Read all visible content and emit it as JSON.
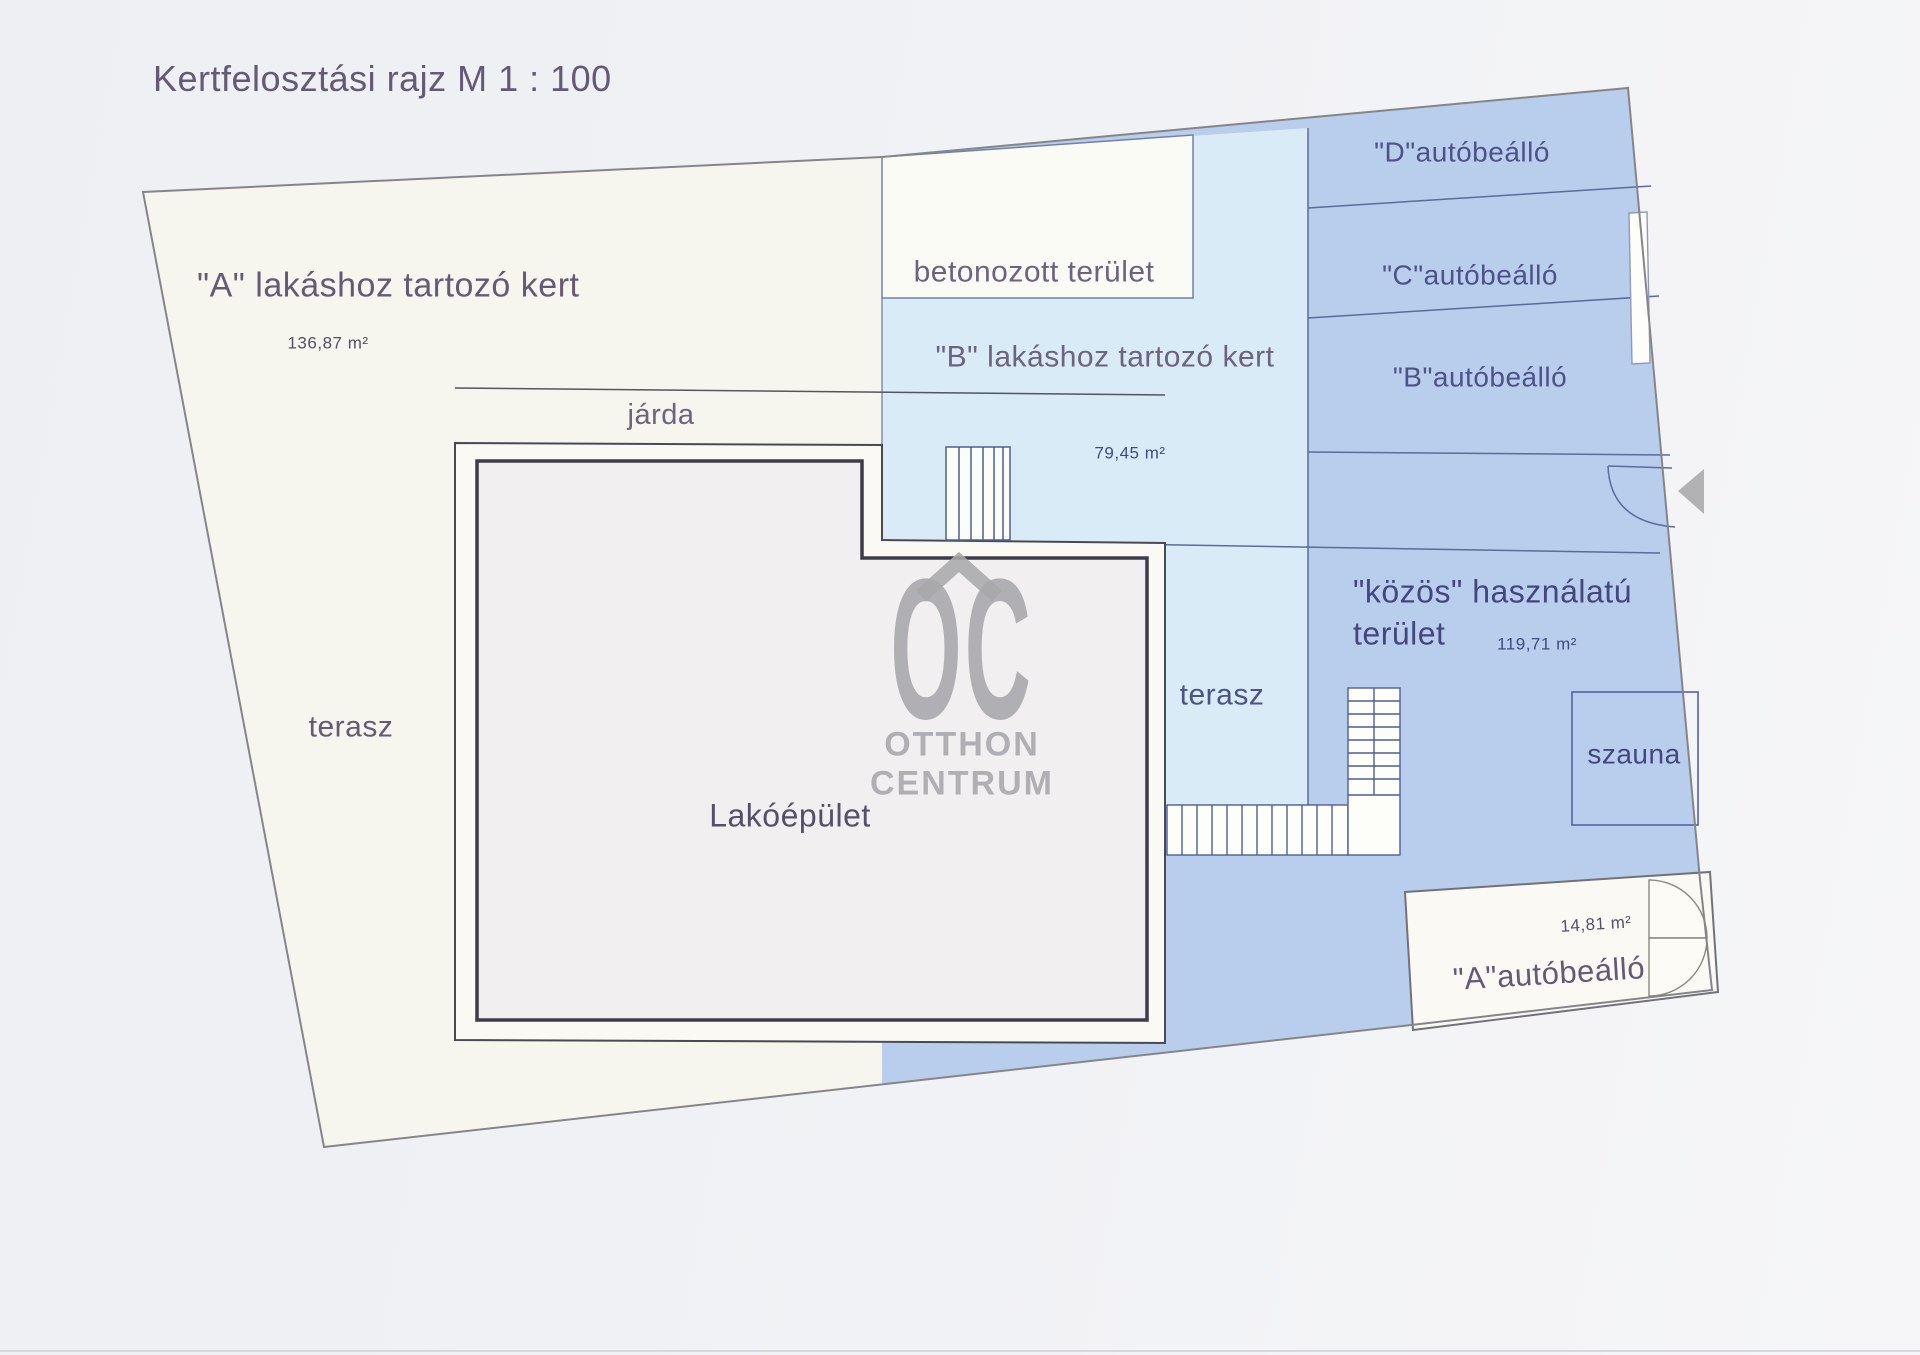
{
  "title": "Kertfelosztási rajz M 1 : 100",
  "areas": {
    "kert_a": {
      "label": "\"A\" lakáshoz tartozó kert",
      "area": "136,87 m²"
    },
    "betonozott": {
      "label": "betonozott terület"
    },
    "kert_b": {
      "label": "\"B\" lakáshoz tartozó kert",
      "area": "79,45 m²"
    },
    "jarda": {
      "label": "járda"
    },
    "terasz_left": {
      "label": "terasz"
    },
    "terasz_right": {
      "label": "terasz"
    },
    "lakoepulet": {
      "label": "Lakóépület"
    },
    "kozos": {
      "label_line1": "\"közös\" használatú",
      "label_line2": "terület",
      "area": "119,71 m²"
    },
    "szauna": {
      "label": "szauna"
    },
    "parking_d": {
      "label": "\"D\"autóbeálló"
    },
    "parking_c": {
      "label": "\"C\"autóbeálló"
    },
    "parking_b": {
      "label": "\"B\"autóbeálló"
    },
    "parking_a": {
      "label": "\"A\"autóbeálló",
      "area": "14,81 m²"
    }
  },
  "watermark": {
    "logo": "OC",
    "line1": "OTTHON",
    "line2": "CENTRUM"
  },
  "colors": {
    "plot_cream": "#f7f6ee",
    "garden_blue": "#b9cdec",
    "garden_cyan": "#d9ebf6",
    "label_purple": "#5f5376",
    "label_blue": "#43477e",
    "watermark_grey": "#a8a8ac",
    "line_blue": "#5b6b9c",
    "wall_dark": "#3d3d49"
  }
}
